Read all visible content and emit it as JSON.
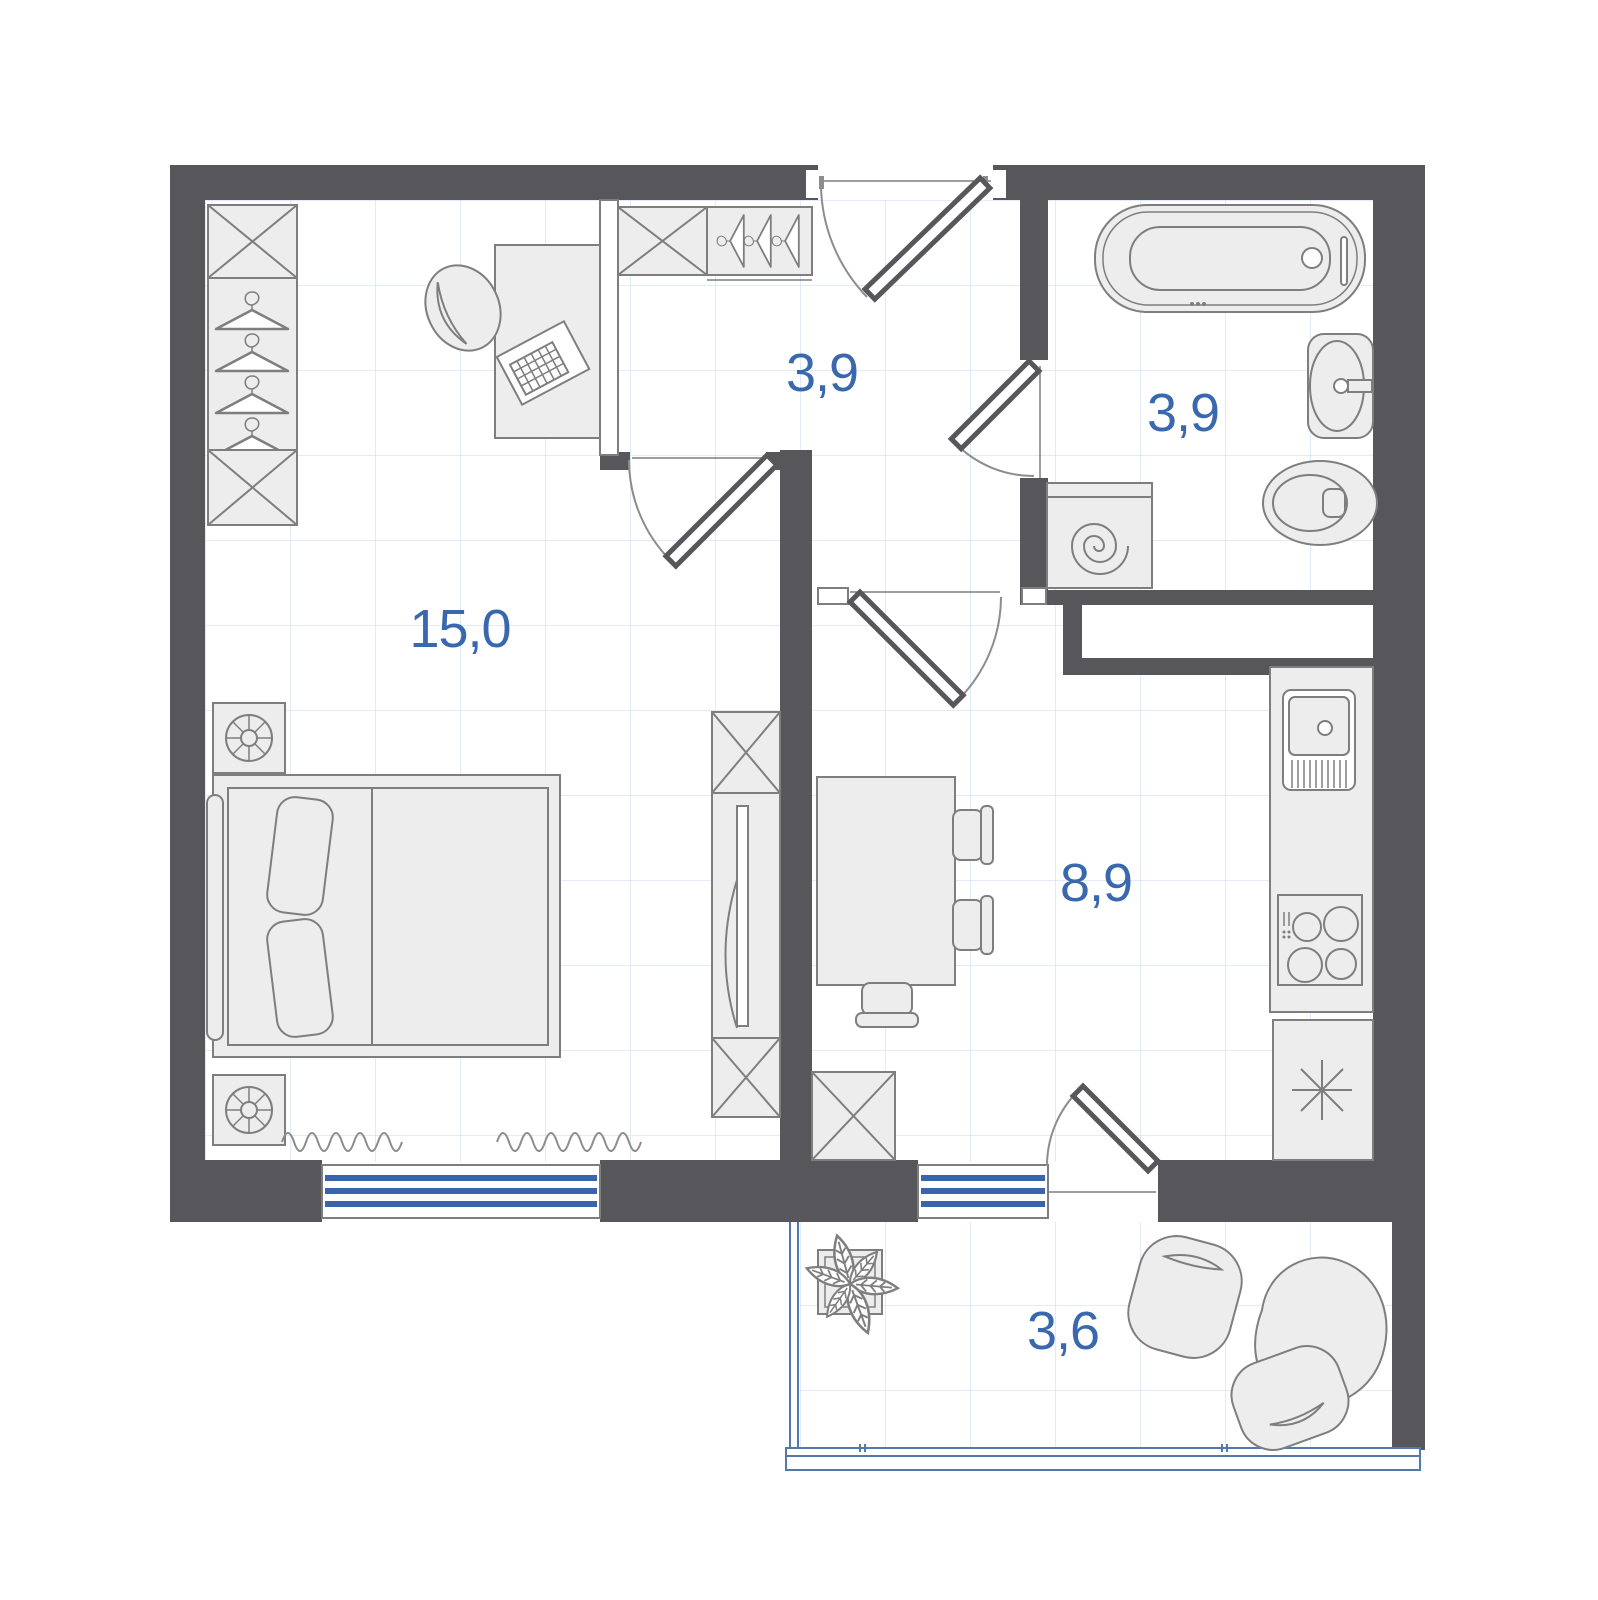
{
  "plan": {
    "rooms": [
      {
        "id": "bedroom",
        "area_label": "15,0"
      },
      {
        "id": "hallway",
        "area_label": "3,9"
      },
      {
        "id": "bathroom",
        "area_label": "3,9"
      },
      {
        "id": "kitchen",
        "area_label": "8,9"
      },
      {
        "id": "balcony",
        "area_label": "3,6"
      }
    ],
    "colors": {
      "wall": "#57575B",
      "label": "#3A68AE",
      "grid": "#D7E6F5",
      "furniture_fill": "#EDEDED",
      "furniture_stroke": "#7E7E7E",
      "radiator_blue": "#3C64AD",
      "glazing_blue": "#5578AB",
      "background": "#FFFFFF"
    },
    "icons": [
      "wardrobe-icon",
      "hanger-icon",
      "desk-icon",
      "laptop-icon",
      "office-chair-icon",
      "nightstand-lamp-icon",
      "double-bed-icon",
      "curtain-icon",
      "tv-cabinet-icon",
      "window-radiator-icon",
      "door-swing-icon",
      "bathtub-icon",
      "washbasin-icon",
      "toilet-icon",
      "washing-machine-icon",
      "vent-shaft",
      "kitchen-sink-icon",
      "stove-icon",
      "fridge-icon",
      "dining-table-icon",
      "chair-icon",
      "cabinet-icon",
      "plant-icon",
      "bean-bag-icon",
      "balcony-glazing-icon"
    ]
  }
}
